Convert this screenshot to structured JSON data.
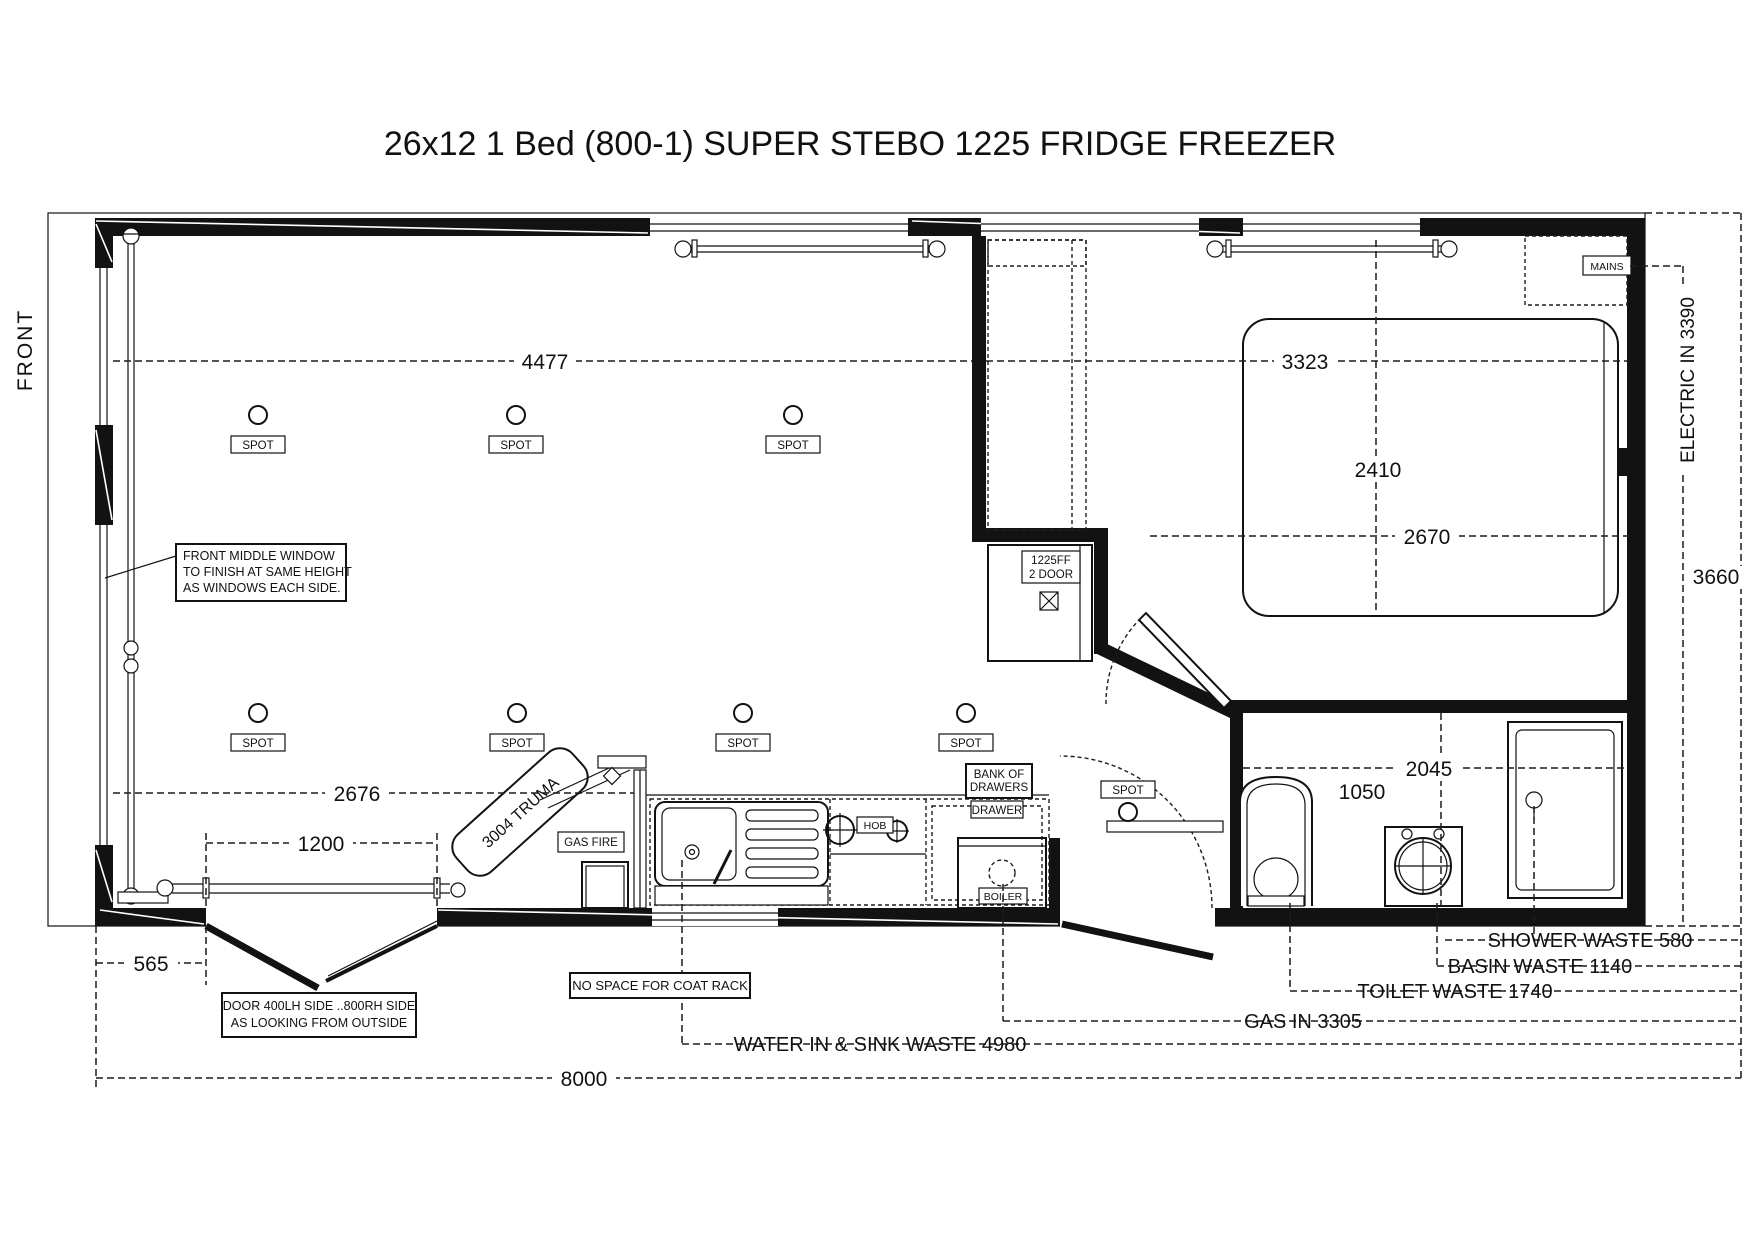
{
  "title": "26x12 1 Bed  (800-1) SUPER  STEBO 1225 FRIDGE FREEZER",
  "side_label": "FRONT",
  "notes": {
    "front_window_1": "FRONT MIDDLE WINDOW",
    "front_window_2": "TO FINISH AT SAME HEIGHT",
    "front_window_3": "AS WINDOWS EACH SIDE.",
    "door_1": "DOOR 400LH SIDE ..800RH SIDE",
    "door_2": "AS LOOKING FROM OUTSIDE",
    "coat_rack": "NO SPACE FOR COAT RACK"
  },
  "fixtures": {
    "spot": "SPOT",
    "gas_fire": "GAS FIRE",
    "truma": "3004 TRUMA",
    "hob": "HOB",
    "bank_of_drawers_1": "BANK OF",
    "bank_of_drawers_2": "DRAWERS",
    "drawer": "DRAWER",
    "boiler": "BOILER",
    "fridge_1": "1225FF",
    "fridge_2": "2 DOOR",
    "mains": "MAINS"
  },
  "dims": {
    "lounge_width": "4477",
    "bedroom_width": "3323",
    "bed_length": "2410",
    "bedroom_depth": "2670",
    "lounge_depth": "2676",
    "door_rail": "1200",
    "door_offset": "565",
    "total_length": "8000",
    "bathroom_width": "2045",
    "toilet_zone": "1050",
    "electric_in": "ELECTRIC IN 3390",
    "right_depth": "3660",
    "shower_waste": "SHOWER WASTE 580",
    "basin_waste": "BASIN WASTE 1140",
    "toilet_waste": "TOILET WASTE 1740",
    "gas_in": "GAS IN 3305",
    "water_in": "WATER IN & SINK WASTE 4980"
  }
}
